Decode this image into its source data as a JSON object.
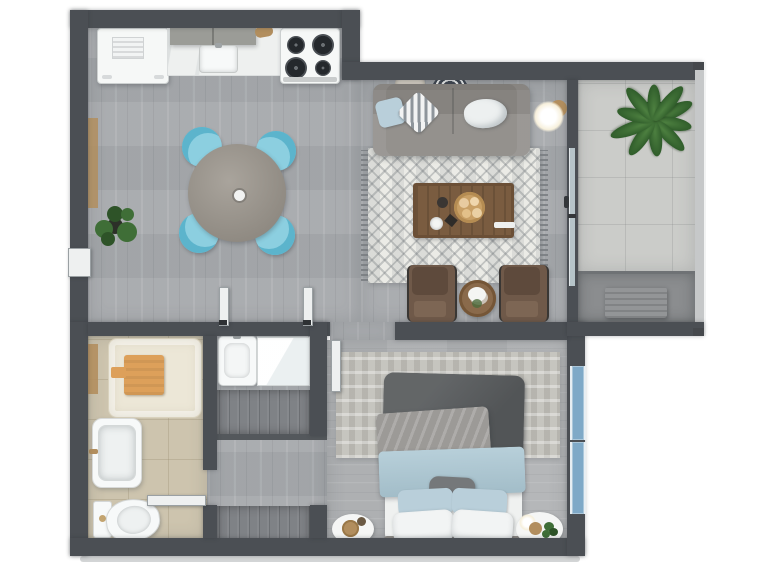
{
  "meta": {
    "title": "3D apartment floor plan, top-down render",
    "view": "top-down",
    "visible_text": "none"
  },
  "palette": {
    "background": "#ffffff",
    "wall": "#4b4f54",
    "wall_outer_light": "#c6c8c9",
    "floor_wood_main": "#a6a9ac",
    "floor_wood_bedroom": "#b1b3b5",
    "floor_tile_balcony": "#cbccc9",
    "floor_tile_bathroom": "#cdc4ae",
    "floor_utility": "#8b8d8f",
    "shower_tray": "#ece7d7",
    "towel_orange": "#dda05a",
    "wood_accent": "#b28e5e",
    "appliance_white": "#f6f8f7",
    "counter_marble": "#eef0ef",
    "cabinet_upper": "#9b9c97",
    "dining_table": "#9b958c",
    "chair_blue": "#8ccfe0",
    "chair_blue_rim": "#5cb4cc",
    "sofa_gray": "#8d8a86",
    "rug_living": "#ebebe6",
    "coffee_table_wood": "#7a5c40",
    "armchair_brown": "#6f5949",
    "side_table_wood": "#8a6a4b",
    "lamp_glow": "#fdfcf5",
    "plant_green": "#3f6e37",
    "plant_green_dark": "#2e5328",
    "ac_unit": "#939597",
    "glass_blue": "#b6c4c9",
    "window_blue": "#7fa9c7",
    "bed_blanket": "#595c5e",
    "bed_throw_gray": "#9c9a97",
    "bed_throw_blue": "#abc7d3",
    "bed_sheet_white": "#eff1f0",
    "pillow_blue": "#b9cfda",
    "pillow_gray": "#75787a",
    "headboard": "#8f8c88",
    "rug_bedroom": "#c6c5bf",
    "wardrobe_gray": "#7f8286",
    "fixture_white": "#f7f9f9",
    "door_white": "#eef0f0"
  },
  "rooms": [
    {
      "name": "kitchen",
      "furniture": [
        "refrigerator",
        "marble counter with sink",
        "upper cabinets",
        "gas stove with 4 burners",
        "cutting board"
      ]
    },
    {
      "name": "dining-area",
      "furniture": [
        "round dining table",
        "4 light-blue tub chairs",
        "potted plant",
        "wooden wall shelf"
      ]
    },
    {
      "name": "living-room",
      "furniture": [
        "gray sofa with 3 pillows",
        "geometric area rug",
        "wooden coffee table with tray",
        "floor lamp",
        "2 brown armchairs",
        "round side table with flowers",
        "2 decorative wall plates"
      ]
    },
    {
      "name": "balcony",
      "furniture": [
        "large potted plant",
        "ac condenser unit",
        "sliding glass door"
      ]
    },
    {
      "name": "bathroom",
      "furniture": [
        "shower tray with orange towel",
        "bathtub",
        "toilet",
        "wooden towel bar"
      ]
    },
    {
      "name": "vanity-closet-area",
      "furniture": [
        "washbasin",
        "glossy white counter with mirror",
        "wardrobe",
        "linen closet",
        "open door leaves"
      ]
    },
    {
      "name": "bedroom",
      "furniture": [
        "double bed with dark blanket and blue throw",
        "patterned rug",
        "2 round nightstands",
        "bedside lamp",
        "small plant",
        "blue window wall"
      ]
    }
  ]
}
